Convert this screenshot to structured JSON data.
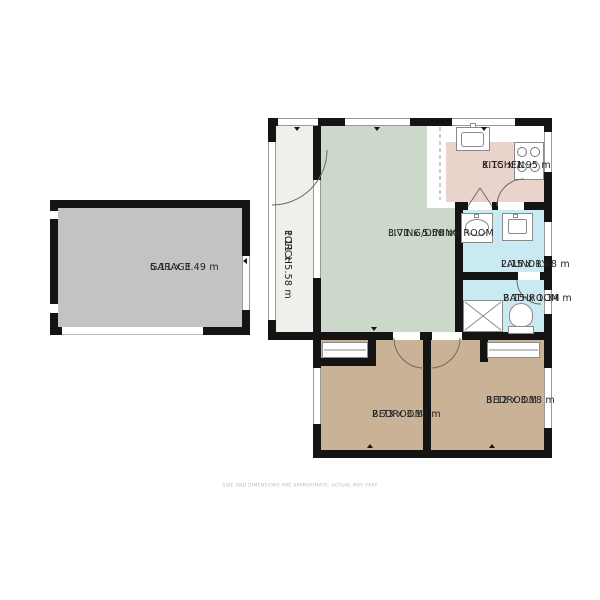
{
  "disclaimer": "SIZE AND DIMENSIONS ARE APPROXIMATE, ACTUAL MAY VARY",
  "rooms": {
    "garage": {
      "name": "GARAGE",
      "dims": "5.11 x 3.49 m"
    },
    "porch": {
      "name": "PORCH",
      "dims": "1.11 x 5.58 m"
    },
    "living": {
      "name": "LIVING/DINING ROOM",
      "dims": "3.71 x 5.58 m"
    },
    "kitchen": {
      "name": "KITCHEN",
      "dims": "3.15 x 1.95 m"
    },
    "laundry": {
      "name": "LAUNDRY",
      "dims": "2.15 x 1.48 m"
    },
    "bathroom": {
      "name": "BATHROOM",
      "dims": "2.15 x 1.34 m"
    },
    "bedroom_left": {
      "name": "BEDROOM",
      "dims": "2.73 x 3.18 m"
    },
    "bedroom_right": {
      "name": "BEDROOM",
      "dims": "3.12 x 3.18 m"
    }
  },
  "colors": {
    "wall": "#141414",
    "garage": "#c3c3c3",
    "porch": "#efefec",
    "living": "#ccd8c9",
    "kitchen": "#e9d3cb",
    "wet_room": "#c9eaf3",
    "bedroom": "#c9b296",
    "fixture_outline": "#8a8a8a",
    "label_text": "#222222",
    "disclaimer_text": "#b9b9b9"
  },
  "icons": {
    "kitchen_sink": "kitchen-sink-icon",
    "stove": "stove-burners-icon",
    "washbasin": "washbasin-icon",
    "laundry_sink": "laundry-sink-icon",
    "shower": "shower-icon",
    "toilet": "toilet-icon"
  }
}
